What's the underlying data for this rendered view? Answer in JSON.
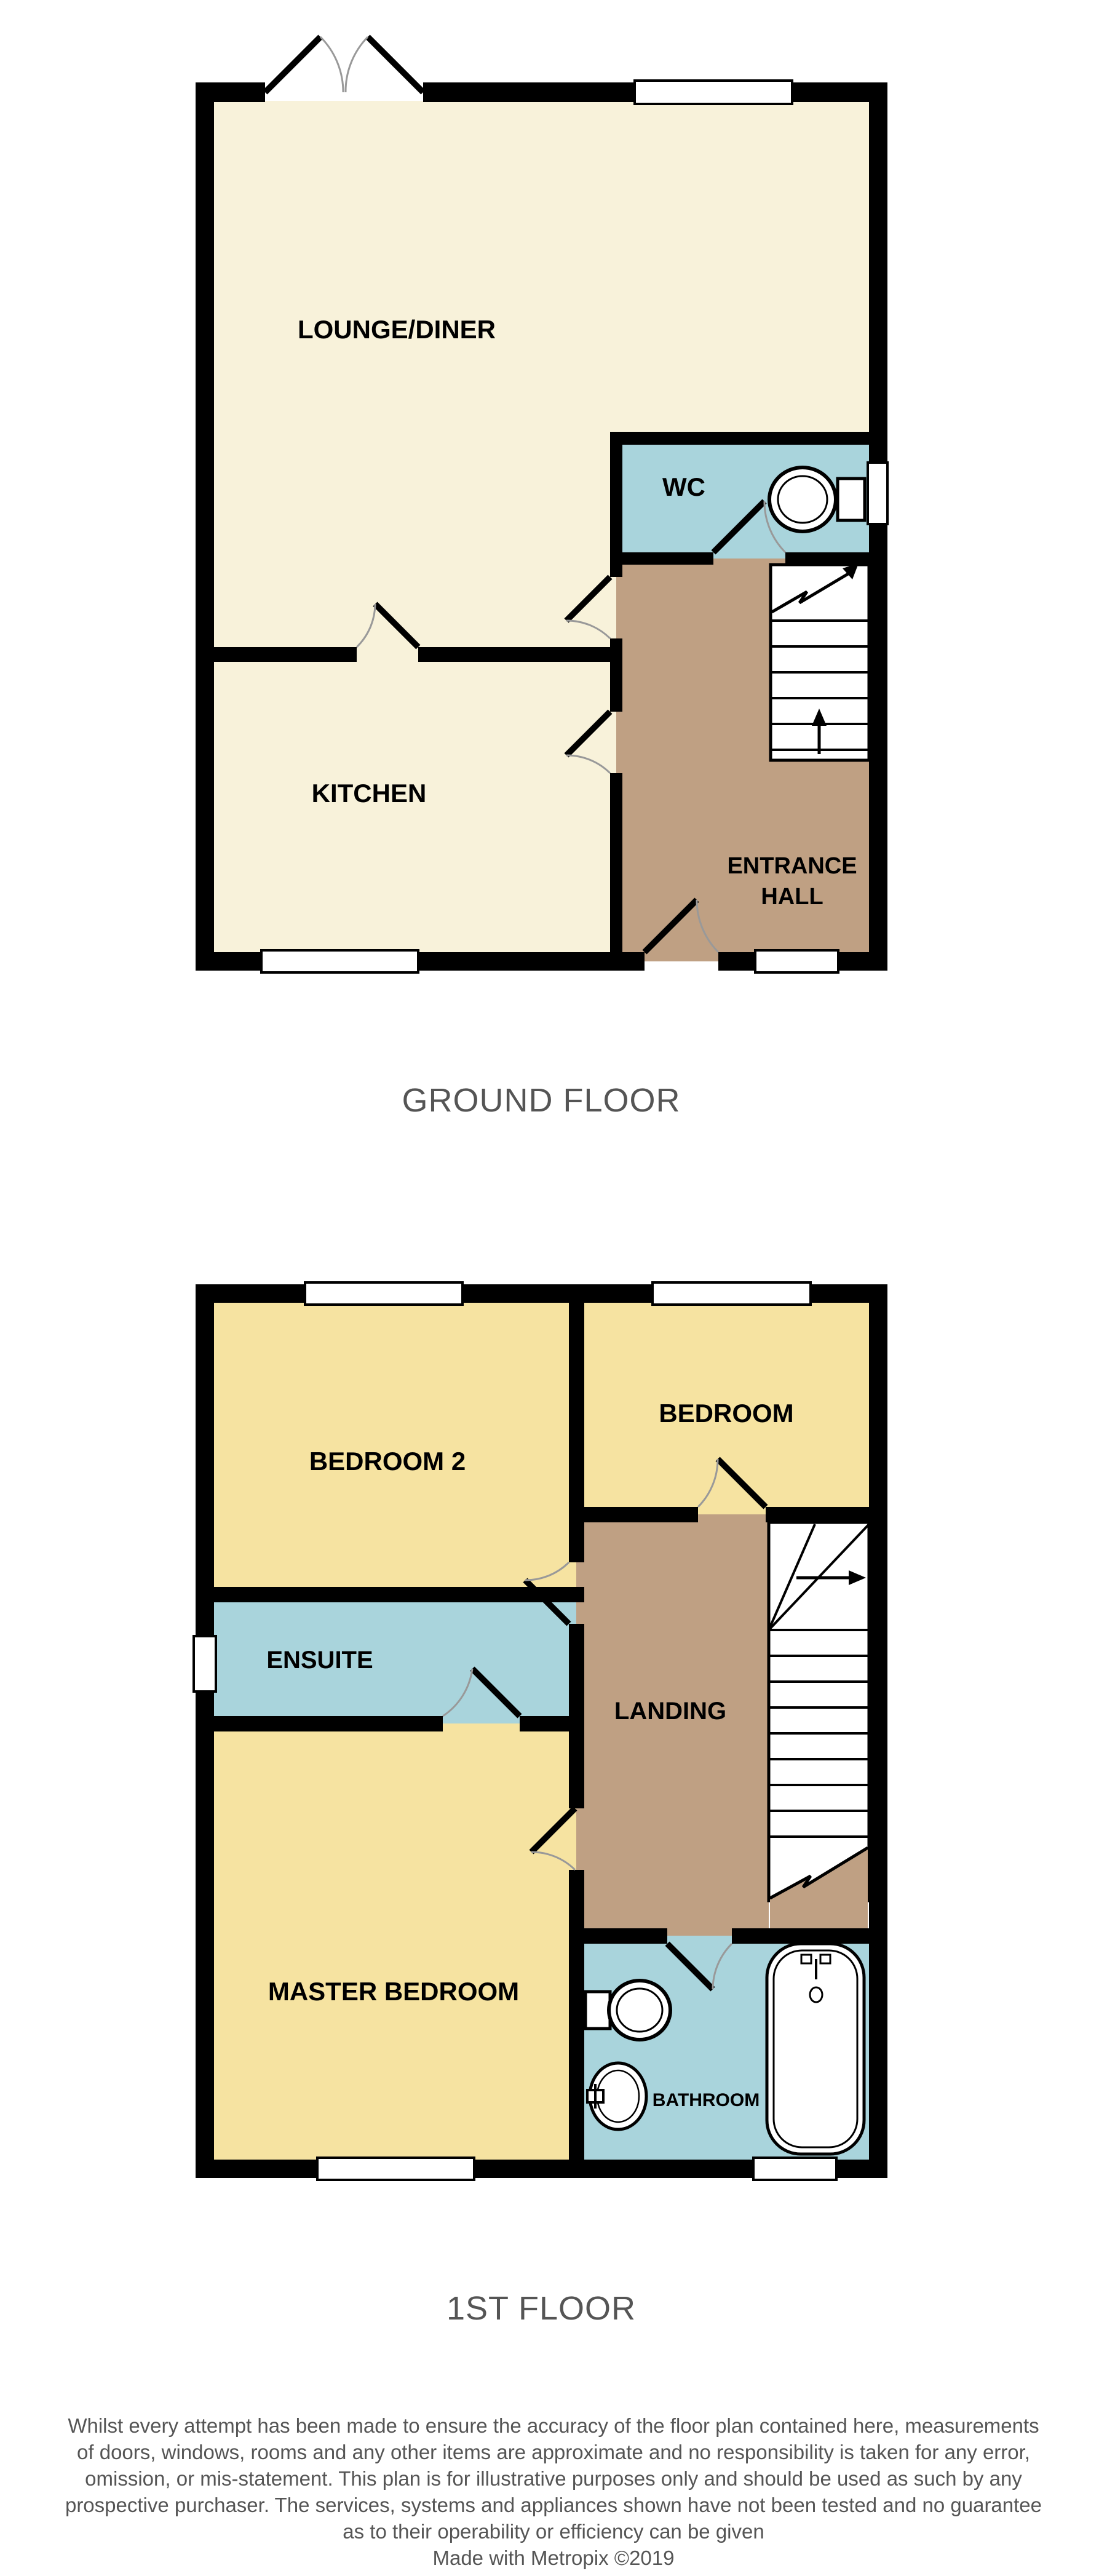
{
  "ground_floor": {
    "caption": "GROUND FLOOR",
    "rooms": {
      "lounge_diner": "LOUNGE/DINER",
      "wc": "WC",
      "kitchen": "KITCHEN",
      "entrance_hall_line1": "ENTRANCE",
      "entrance_hall_line2": "HALL"
    }
  },
  "first_floor": {
    "caption": "1ST FLOOR",
    "rooms": {
      "bedroom2": "BEDROOM 2",
      "bedroom": "BEDROOM",
      "ensuite": "ENSUITE",
      "landing": "LANDING",
      "master_bedroom": "MASTER BEDROOM",
      "bathroom": "BATHROOM"
    }
  },
  "disclaimer": {
    "lines": [
      "Whilst every attempt has been made to ensure the accuracy of the floor plan contained here, measurements",
      "of doors, windows, rooms and any other items are approximate and no responsibility is taken for any error,",
      "omission, or mis-statement. This plan is for illustrative purposes only and should be used as such by any",
      "prospective purchaser. The services, systems and appliances shown have not been tested and no guarantee",
      "as to their operability or efficiency can be given",
      "Made with Metropix ©2019"
    ]
  },
  "colors": {
    "floor_cream": "#F8F2DA",
    "floor_yellow": "#F6E3A1",
    "floor_blue": "#A9D4DC",
    "floor_tan": "#BFA083",
    "wall": "#000000",
    "caption_text": "#555555",
    "door_arc": "#999999"
  },
  "icons": [
    "toilet-icon",
    "bath-icon",
    "sink-icon",
    "stairs-up-arrow-icon",
    "stairs-break-arrow-icon"
  ]
}
